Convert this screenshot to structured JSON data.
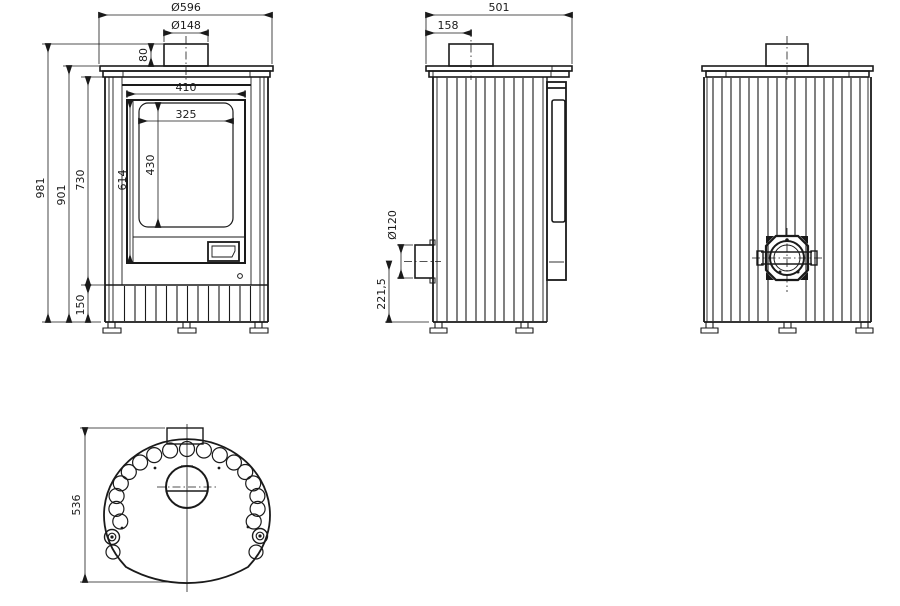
{
  "title": "Stove technical drawing",
  "colors": {
    "line": "#1a1a1a",
    "background": "#ffffff"
  },
  "views": {
    "front": {
      "dims": {
        "top_plate_diameter": "Ø596",
        "flue_diameter": "Ø148",
        "flue_collar_height": "80",
        "door_width": "410",
        "glass_width": "325",
        "glass_height": "430",
        "door_height": "614",
        "body_height": "730",
        "height_to_top_plate": "901",
        "total_height": "981",
        "plinth_height": "150"
      }
    },
    "side": {
      "dims": {
        "depth": "501",
        "flue_center_from_back": "158",
        "air_inlet_diameter": "Ø120",
        "air_inlet_center_height": "221,5"
      }
    },
    "rear": {
      "dims": {}
    },
    "top": {
      "dims": {
        "body_width": "536"
      }
    }
  }
}
